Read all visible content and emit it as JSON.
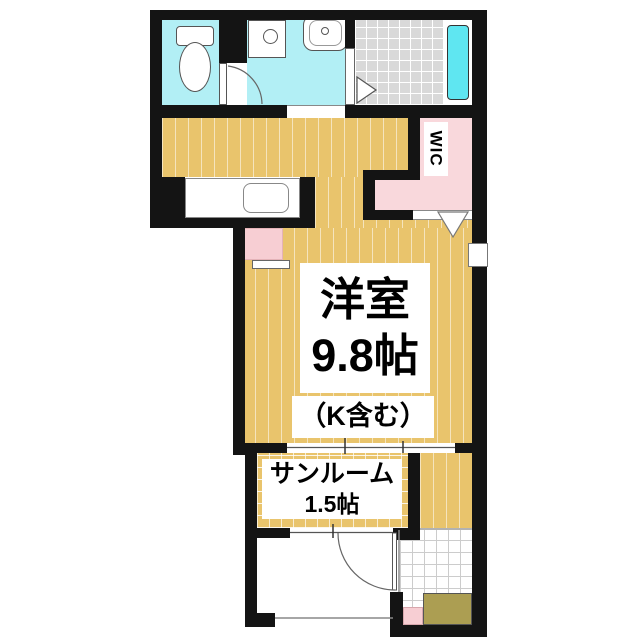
{
  "labels": {
    "main_room_name": "洋室",
    "main_room_size": "9.8帖",
    "main_room_note": "（K含む）",
    "sunroom_name": "サンルーム",
    "sunroom_size": "1.5帖",
    "wic": "WIC"
  },
  "colors": {
    "wall": "#141414",
    "wood": "#e9c46c",
    "wet": "#b2eff5",
    "tub": "#5fe6f1",
    "tile": "#d9d9d9",
    "closet": "#f9d8dc",
    "step": "#ac9e52",
    "pinkfix": "#f7ced3"
  }
}
